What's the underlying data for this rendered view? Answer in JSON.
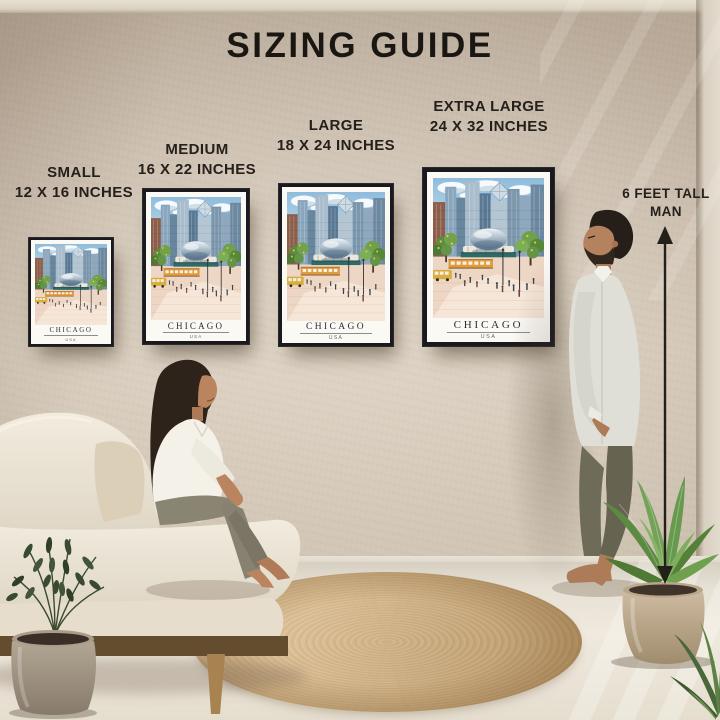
{
  "title": "SIZING GUIDE",
  "sizes": [
    {
      "id": "small",
      "name": "SMALL",
      "dimensions": "12 X 16 INCHES"
    },
    {
      "id": "medium",
      "name": "MEDIUM",
      "dimensions": "16 X 22 INCHES"
    },
    {
      "id": "large",
      "name": "LARGE",
      "dimensions": "18 X 24 INCHES"
    },
    {
      "id": "extra-large",
      "name": "EXTRA LARGE",
      "dimensions": "24 X 32 INCHES"
    }
  ],
  "height_marker": {
    "line1": "6 FEET TALL",
    "line2": "MAN"
  },
  "poster": {
    "title": "CHICAGO",
    "subtitle": "USA"
  },
  "colors": {
    "wall": "#c6b8a9",
    "floor": "#e9e3d7",
    "rug": "#c9a97c",
    "frame": "#1a191d",
    "title_text": "#1a1713",
    "arrow": "#222018",
    "poster_sky": "#8fbcdc",
    "poster_teal": "#2e6a66",
    "poster_tram": "#e29a3b"
  }
}
